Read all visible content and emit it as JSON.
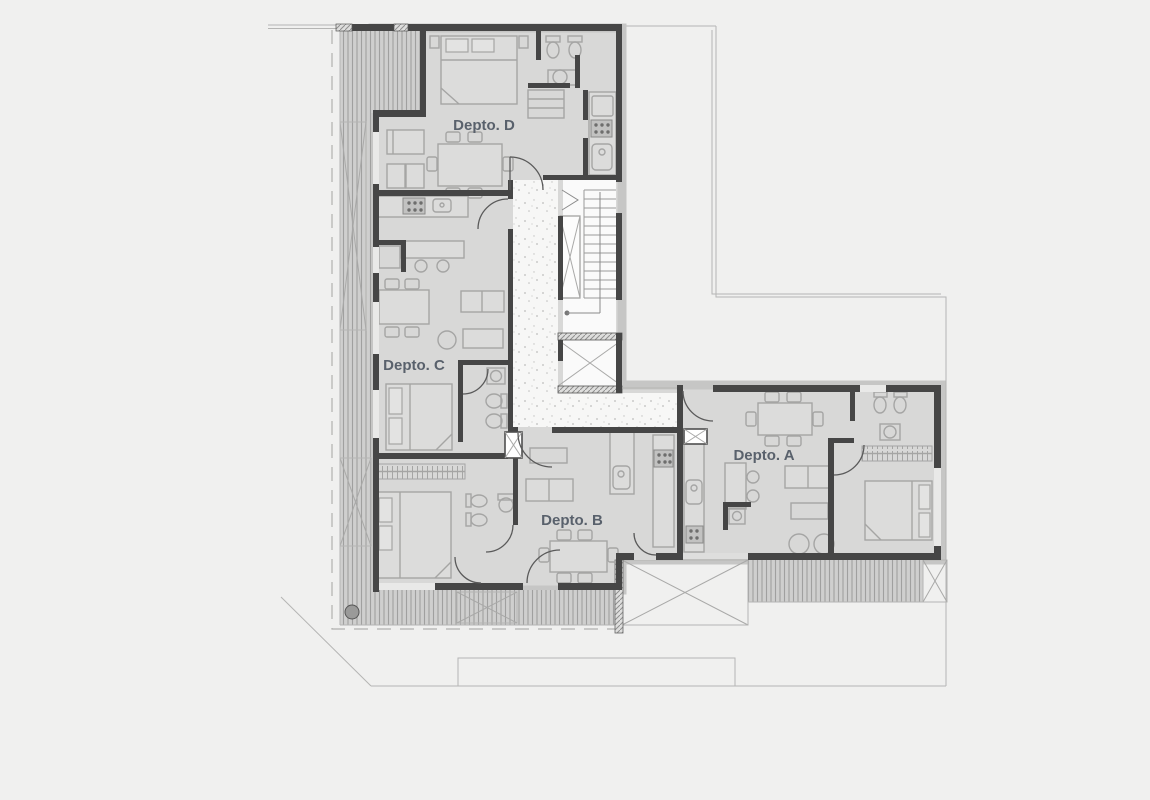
{
  "plan": {
    "type": "architectural-floor-plan",
    "units": [
      {
        "id": "A",
        "label": "Depto. A"
      },
      {
        "id": "B",
        "label": "Depto. B"
      },
      {
        "id": "C",
        "label": "Depto. C"
      },
      {
        "id": "D",
        "label": "Depto. D"
      }
    ],
    "colors": {
      "background": "#f0f0ef",
      "floor": "#d8d8d7",
      "wall": "#464646",
      "furniture_line": "#a5a5a4",
      "deck_stripe": "#a0a09f",
      "lot_line": "#b5b5b4",
      "label_text": "#59616c"
    }
  }
}
